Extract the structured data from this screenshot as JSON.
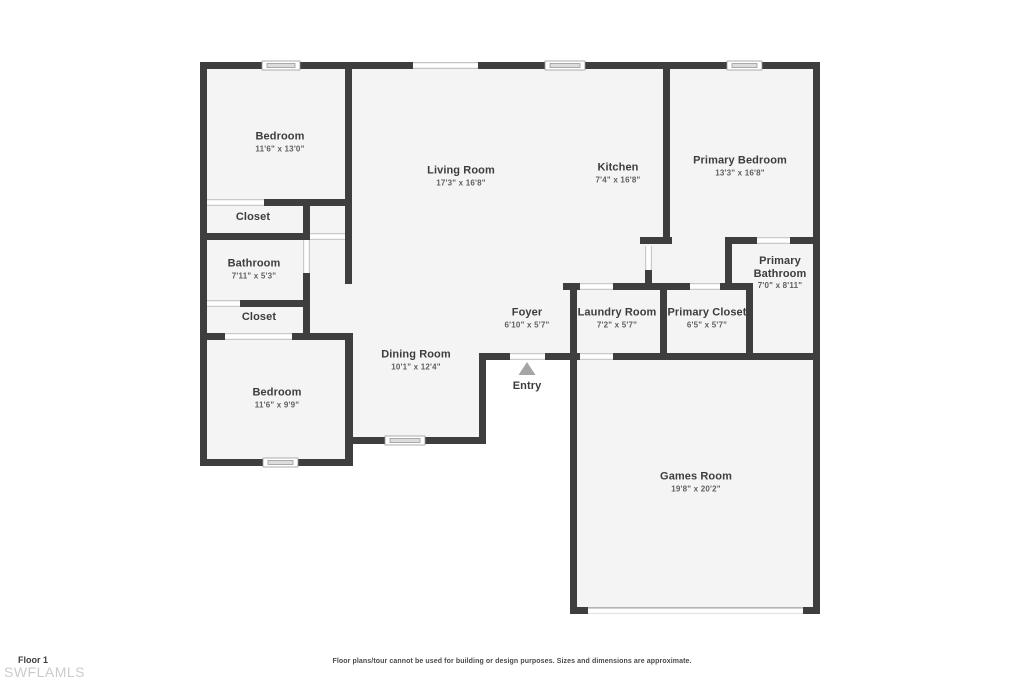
{
  "plan": {
    "rooms": [
      {
        "id": "bedroom-1",
        "name": "Bedroom",
        "dims": "11'6\" x 13'0\"",
        "cx": 280,
        "cy": 142
      },
      {
        "id": "living-room",
        "name": "Living Room",
        "dims": "17'3\" x 16'8\"",
        "cx": 461,
        "cy": 176
      },
      {
        "id": "kitchen",
        "name": "Kitchen",
        "dims": "7'4\" x 16'8\"",
        "cx": 618,
        "cy": 173
      },
      {
        "id": "primary-bedroom",
        "name": "Primary Bedroom",
        "dims": "13'3\" x 16'8\"",
        "cx": 740,
        "cy": 166
      },
      {
        "id": "closet-1",
        "name": "Closet",
        "dims": "",
        "cx": 253,
        "cy": 217
      },
      {
        "id": "bathroom",
        "name": "Bathroom",
        "dims": "7'11\" x 5'3\"",
        "cx": 254,
        "cy": 269
      },
      {
        "id": "closet-2",
        "name": "Closet",
        "dims": "",
        "cx": 259,
        "cy": 317
      },
      {
        "id": "bedroom-2",
        "name": "Bedroom",
        "dims": "11'6\" x 9'9\"",
        "cx": 277,
        "cy": 398
      },
      {
        "id": "dining-room",
        "name": "Dining Room",
        "dims": "10'1\" x 12'4\"",
        "cx": 416,
        "cy": 360
      },
      {
        "id": "foyer",
        "name": "Foyer",
        "dims": "6'10\" x 5'7\"",
        "cx": 527,
        "cy": 318
      },
      {
        "id": "laundry-room",
        "name": "Laundry Room",
        "dims": "7'2\" x 5'7\"",
        "cx": 617,
        "cy": 318
      },
      {
        "id": "primary-closet",
        "name": "Primary Closet",
        "dims": "6'5\" x 5'7\"",
        "cx": 707,
        "cy": 318
      },
      {
        "id": "primary-bathroom",
        "name": "Primary Bathroom",
        "dims": "7'0\" x 8'11\"",
        "cx": 780,
        "cy": 273,
        "wrap": true
      },
      {
        "id": "games-room",
        "name": "Games Room",
        "dims": "19'8\" x 20'2\"",
        "cx": 696,
        "cy": 482
      },
      {
        "id": "entry",
        "name": "Entry",
        "dims": "",
        "cx": 527,
        "cy": 386
      }
    ],
    "entry_marker": "triangle-up"
  },
  "footer": {
    "floor_label": "Floor 1",
    "watermark": "SWFLAMLS",
    "disclaimer": "Floor plans/tour cannot be used for building or design purposes. Sizes and dimensions are approximate."
  },
  "colors": {
    "wall": "#3e3e3e",
    "floor": "#f4f4f4",
    "room_name_text": "#3d3d3d",
    "dimension_text": "#5f5f5f",
    "entry_arrow": "#a5a5a5",
    "watermark_text": "#c9ccce"
  }
}
